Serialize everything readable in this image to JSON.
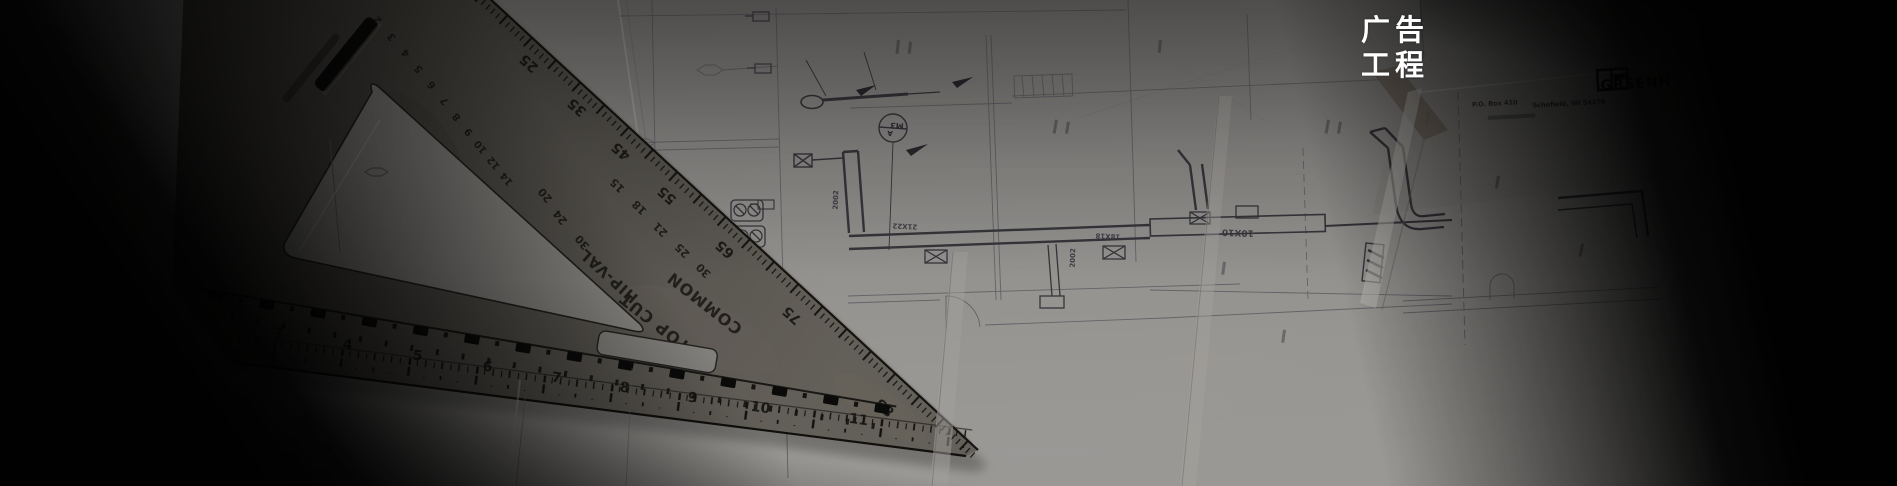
{
  "title": {
    "line1": "广告",
    "line2": "工程"
  },
  "colors": {
    "paper": "#9c9a97",
    "metal": "#56534c",
    "blueprint_line": "#3c3c44",
    "caption_text": "#ffffff",
    "vignette": "#000000"
  },
  "square": {
    "bottom_scale": [
      "3",
      "4",
      "5",
      "6",
      "7",
      "8",
      "9",
      "10",
      "11"
    ],
    "degree_scale": [
      "25",
      "35",
      "45",
      "55",
      "65",
      "75",
      "85"
    ],
    "inner_scale": [
      "2",
      "3",
      "4",
      "5",
      "6",
      "7",
      "8",
      "9",
      "10",
      "12",
      "14"
    ],
    "hipval_scale": [
      "20",
      "24",
      "30"
    ],
    "common_scale": [
      "15",
      "18",
      "21",
      "25",
      "30"
    ],
    "label_hipval": "HIP-VAL",
    "label_topcut": "TOP CUT",
    "label_common": "COMMON"
  },
  "blueprint": {
    "duct_label_1": "21X22",
    "duct_label_2": "18X18",
    "duct_label_3": "10X10",
    "duct_label_4": "2002",
    "duct_label_5": "2002",
    "tag_letter": "A",
    "tag_code": "M3",
    "titleblock": {
      "company": "GREENH",
      "po": "P.O. Box 410",
      "city": "Schofield, WI 54476"
    }
  }
}
